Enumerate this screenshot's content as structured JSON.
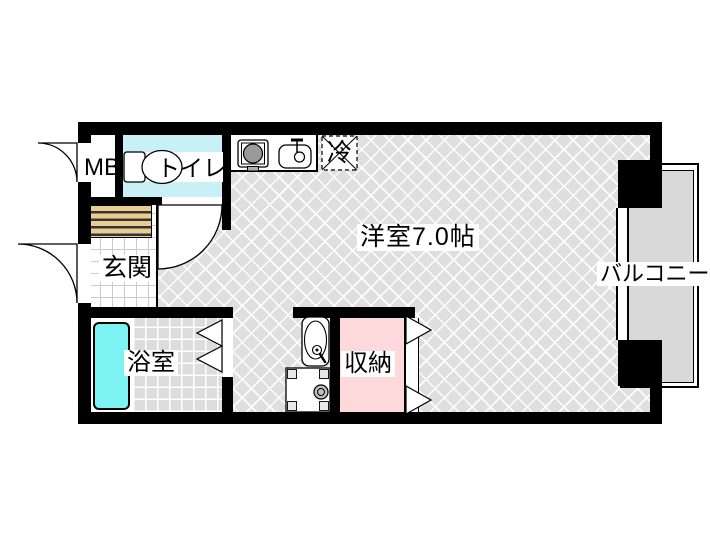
{
  "floorplan": {
    "rooms": {
      "meter_box": {
        "label": "MB"
      },
      "toilet": {
        "label": "トイレ"
      },
      "refrigerator_space": {
        "label": "冷"
      },
      "western_room": {
        "label": "洋室7.0帖"
      },
      "entrance": {
        "label": "玄関"
      },
      "bathroom": {
        "label": "浴室"
      },
      "closet": {
        "label": "収納"
      },
      "balcony": {
        "label": "バルコニー"
      }
    },
    "colors": {
      "wall": "#000000",
      "toilet_floor": "#c9f0f7",
      "bathtub": "#7df2f2",
      "closet_floor": "#fdd9db",
      "entrance_mat": "#e9cc8f",
      "main_room_floor": "#dfdfdf",
      "bathroom_tile": "#dcdcdc",
      "balcony_floor": "#d9d9d9"
    }
  }
}
